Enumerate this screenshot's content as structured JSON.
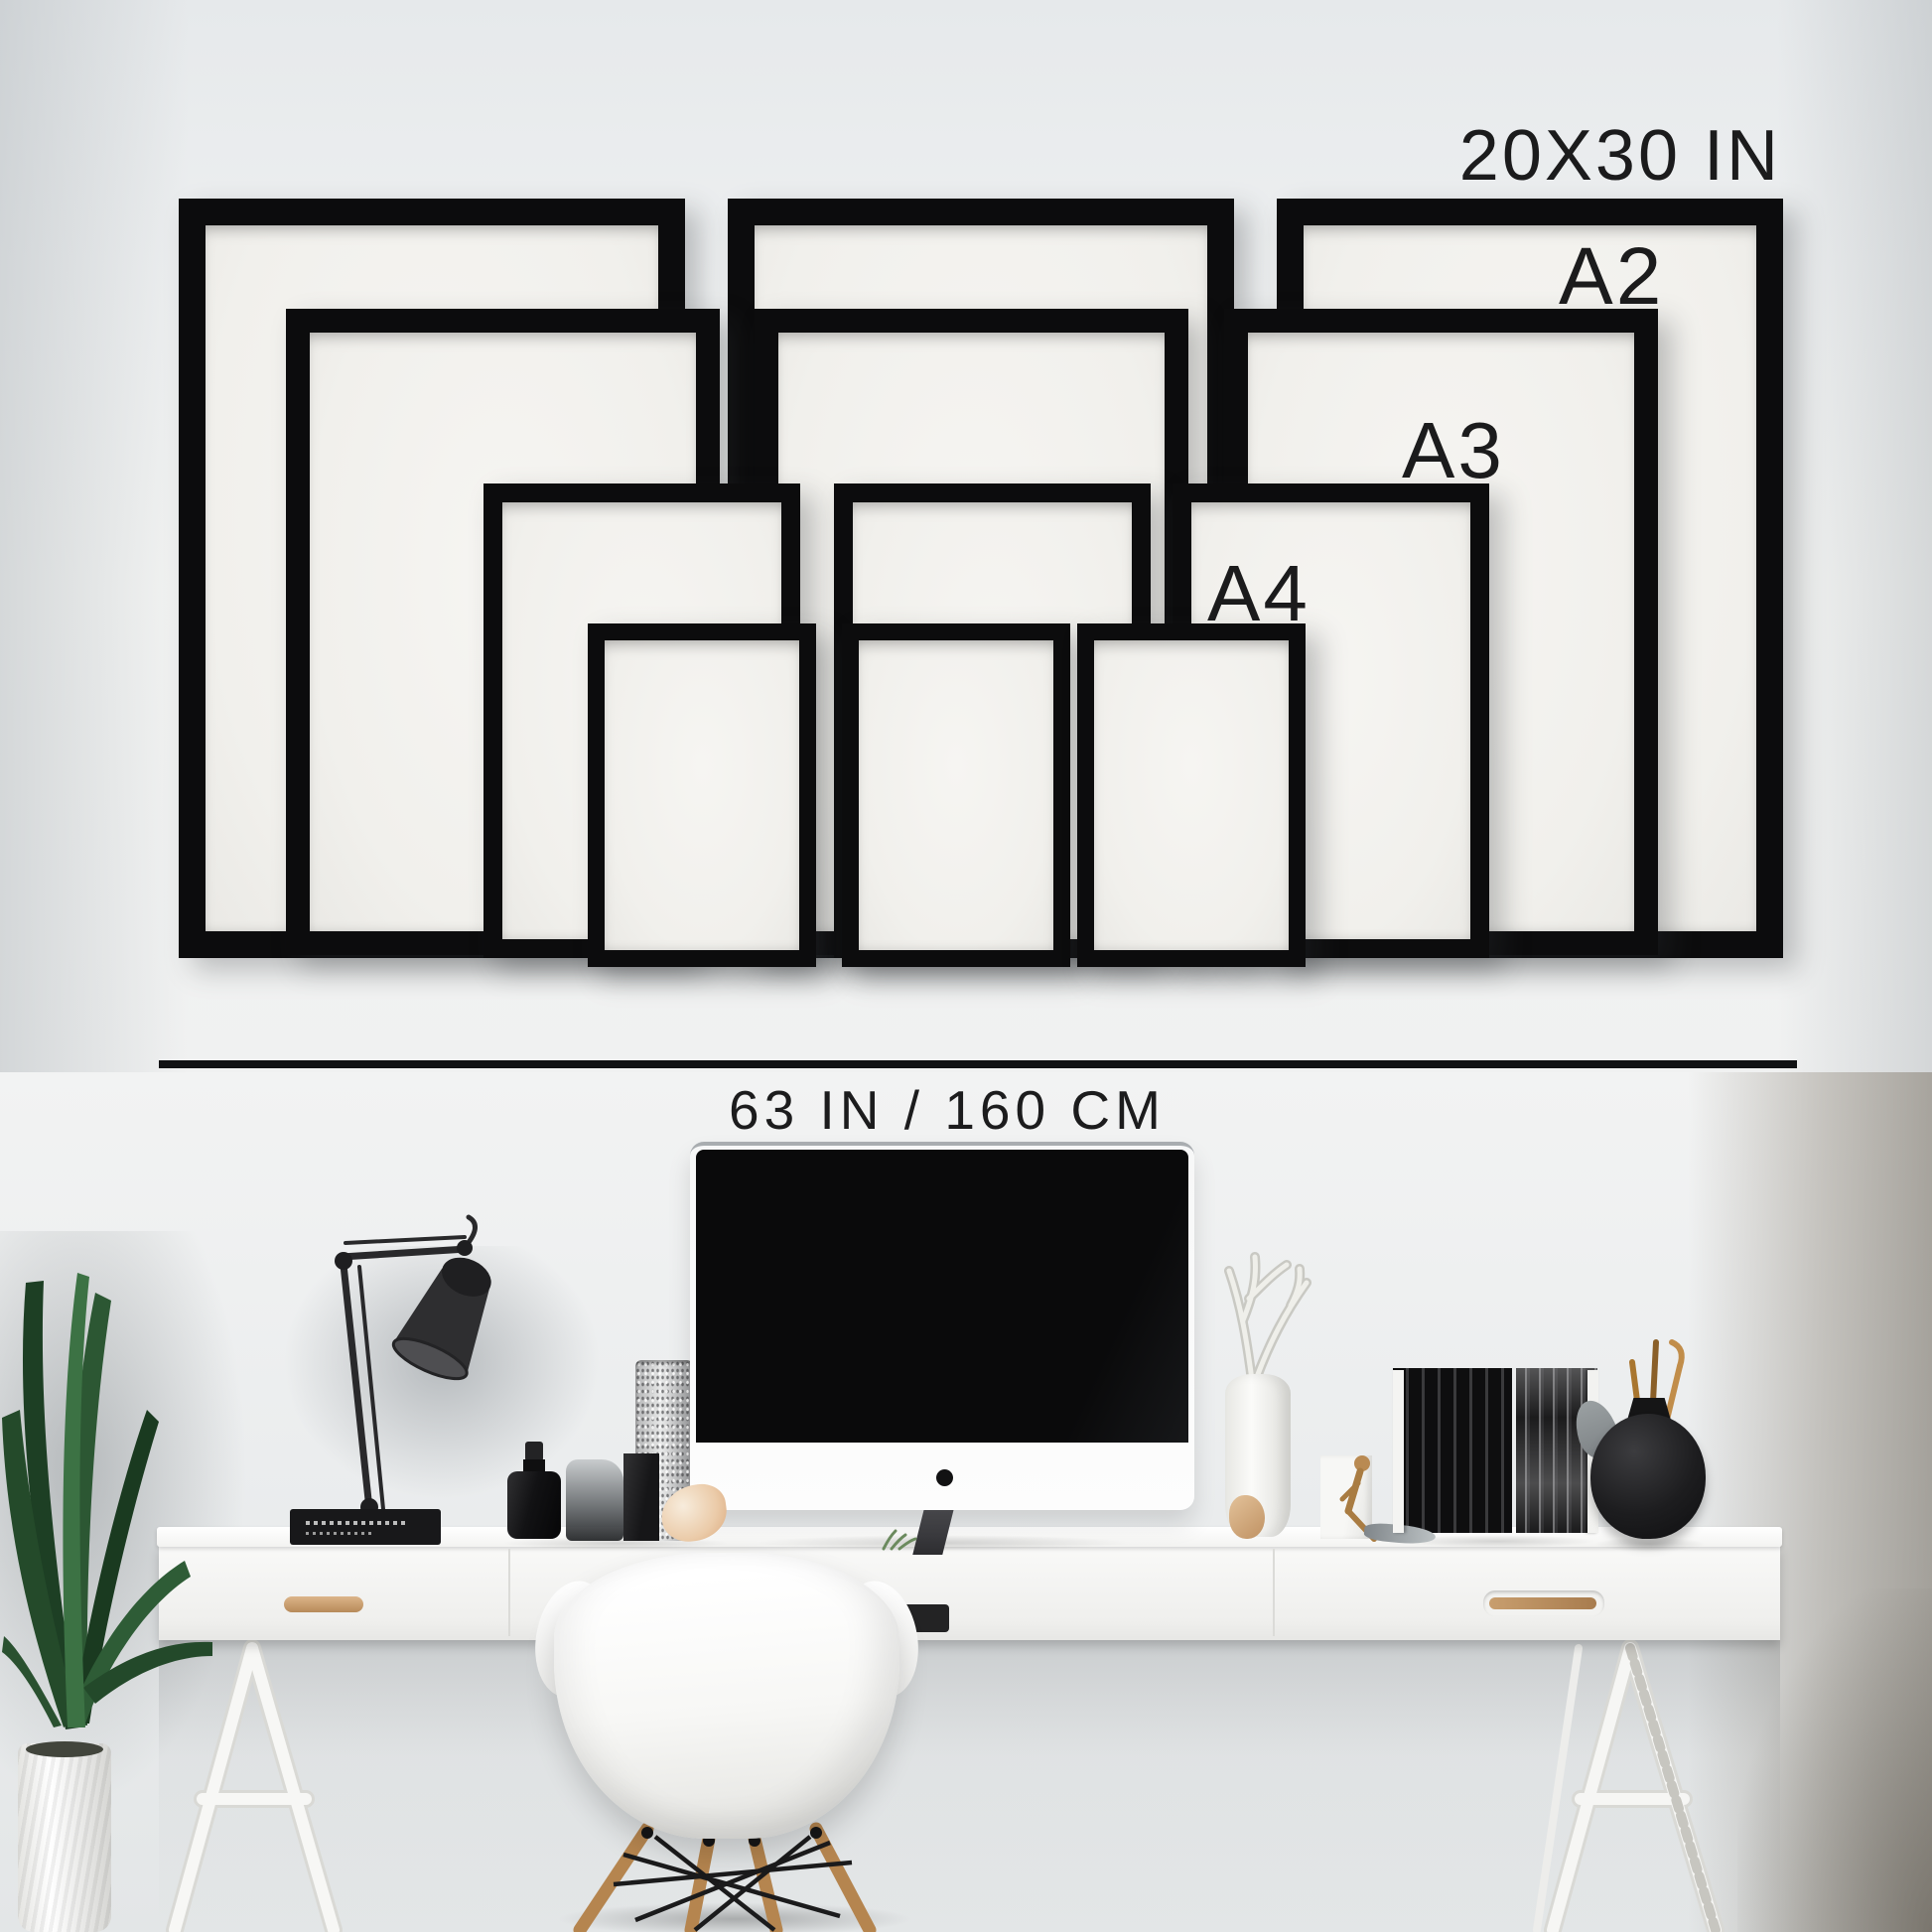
{
  "page": {
    "type": "frame-size-wall-mockup"
  },
  "wall_labels": {
    "largest_size": "20X30 IN",
    "a2": "A2",
    "a3": "A3",
    "a4": "A4"
  },
  "measurement": {
    "total_width": "63 IN / 160 CM"
  },
  "frame_sets": [
    {
      "label": "20X30 IN",
      "count": 3
    },
    {
      "label": "A2",
      "count": 3
    },
    {
      "label": "A3",
      "count": 3
    },
    {
      "label": "A4",
      "count": 3
    }
  ],
  "colors": {
    "frame_black": "#0c0c0d",
    "frame_paper": "#f2f1ed",
    "wall_gray": "#eef0f1",
    "divider_line": "#111214",
    "text": "#1b1b1c",
    "wood_accent": "#b5854f",
    "plant_green": "#2c5733"
  },
  "scene_objects": [
    "palm-plant",
    "white-plant-pot",
    "desk-lamp",
    "lamp-base-books",
    "black-flask",
    "glass-carafe",
    "black-square-vase",
    "textured-silver-vase",
    "seashell",
    "imac-monitor",
    "green-sprig",
    "white-coral-vase",
    "white-box-figurine",
    "black-book-row",
    "dark-book-row",
    "round-black-vase-with-sticks",
    "white-desk",
    "eames-chair",
    "trestle-legs"
  ]
}
